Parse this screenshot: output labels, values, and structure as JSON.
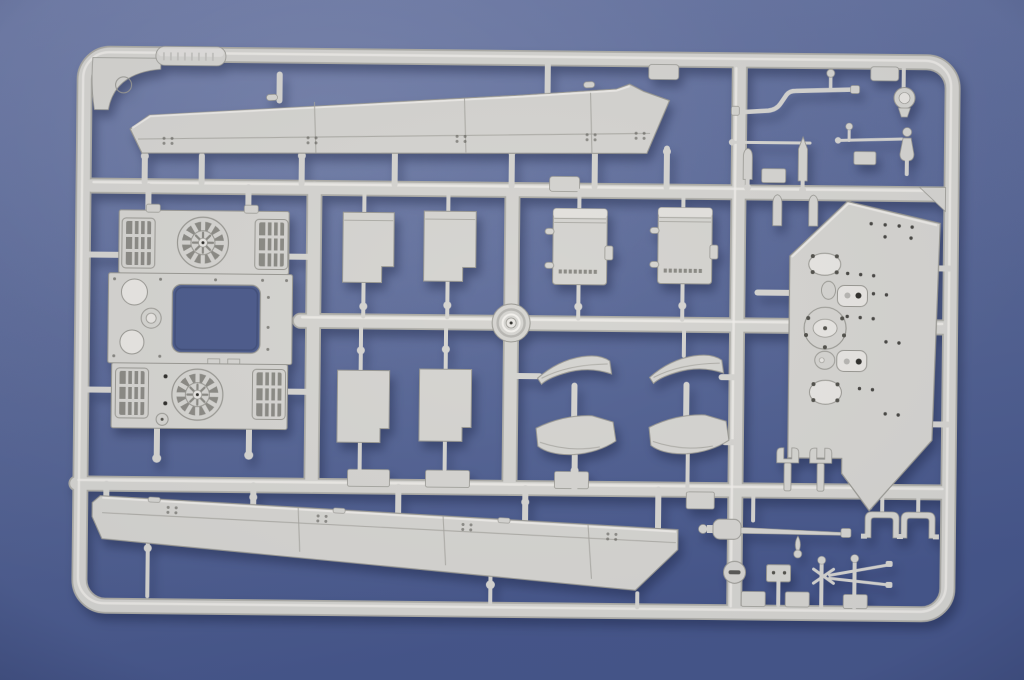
{
  "scene": {
    "type": "photograph",
    "subject": "Injection-molded light-grey styrene sprue (model kit parts tree) photographed on a blue fabric background",
    "label_tab": {
      "text_legible": false,
      "note": "embossed lettering on raised tab, not readable"
    }
  },
  "colors": {
    "bg_top": "#6d7aa7",
    "bg_mid": "#5b6a99",
    "bg_bottom": "#47578c",
    "plastic": "#d6d5d1",
    "plastic_light": "#e8e6e2",
    "plastic_dark": "#b8b7b3",
    "plastic_edge": "#9b9a94",
    "plastic_hi": "#f1efeb",
    "runner_edge": "#adaca6",
    "grille_slot": "#8d8c86",
    "opening": "#4f5e8d",
    "hole": "#33322e",
    "dot": "#55544e",
    "panel_line": "#a6a59f"
  },
  "parts": [
    {
      "name": "sprue-frame",
      "desc": "rounded rectangular outer runner frame with internal cross runners"
    },
    {
      "name": "label-tab",
      "desc": "embossed identification tab on top rail"
    },
    {
      "name": "upper-hull-side",
      "desc": "long tapered hull side panel, rivet rows, top of frame"
    },
    {
      "name": "engine-deck",
      "desc": "square engine deck with two circular cooling fans, four slatted intake grilles, rectangular access opening and round hatches"
    },
    {
      "name": "stowage-box-1",
      "desc": "plain rectangular box part"
    },
    {
      "name": "stowage-box-2",
      "desc": "plain rectangular box part"
    },
    {
      "name": "stowage-bin-1",
      "desc": "rectangular bin with side handles, latch and hinge dashes"
    },
    {
      "name": "stowage-bin-2",
      "desc": "rectangular bin with side handles, latch and hinge dashes"
    },
    {
      "name": "sprue-center-boss",
      "desc": "circular molded boss at runner crossing"
    },
    {
      "name": "hatch-panel-1",
      "desc": "flat rectangular hatch panel"
    },
    {
      "name": "hatch-panel-2",
      "desc": "flat rectangular hatch panel"
    },
    {
      "name": "fender-sections",
      "desc": "four curved mudguard / fender segments in two columns"
    },
    {
      "name": "rear-plate",
      "desc": "large angled hull plate with oval hatches, bolted flange and rows of drilled holes"
    },
    {
      "name": "lower-hull-side",
      "desc": "long hull side panel with panel lines and rivets, bottom of frame"
    },
    {
      "name": "bent-rod",
      "desc": "Z-bent grab rod with pin"
    },
    {
      "name": "light-disc",
      "desc": "small round headlight-like disc"
    },
    {
      "name": "shell-rounds",
      "desc": "small bullet / shell shaped pins"
    },
    {
      "name": "linkage-rods",
      "desc": "thin horizontal rods with knob ends"
    },
    {
      "name": "tow-fork-pins",
      "desc": "two fork-topped pins above lower runner"
    },
    {
      "name": "clamp-brackets",
      "desc": "two staple-shaped clamp brackets"
    },
    {
      "name": "cleaning-rod",
      "desc": "long rod with conical head and teardrop hanger"
    },
    {
      "name": "signal-paddle",
      "desc": "round paddle with horizontal slot"
    },
    {
      "name": "mount-plate",
      "desc": "small plate with two holes"
    },
    {
      "name": "antenna-scissors",
      "desc": "crossed scissors-type mount with two ball-top pins"
    }
  ]
}
